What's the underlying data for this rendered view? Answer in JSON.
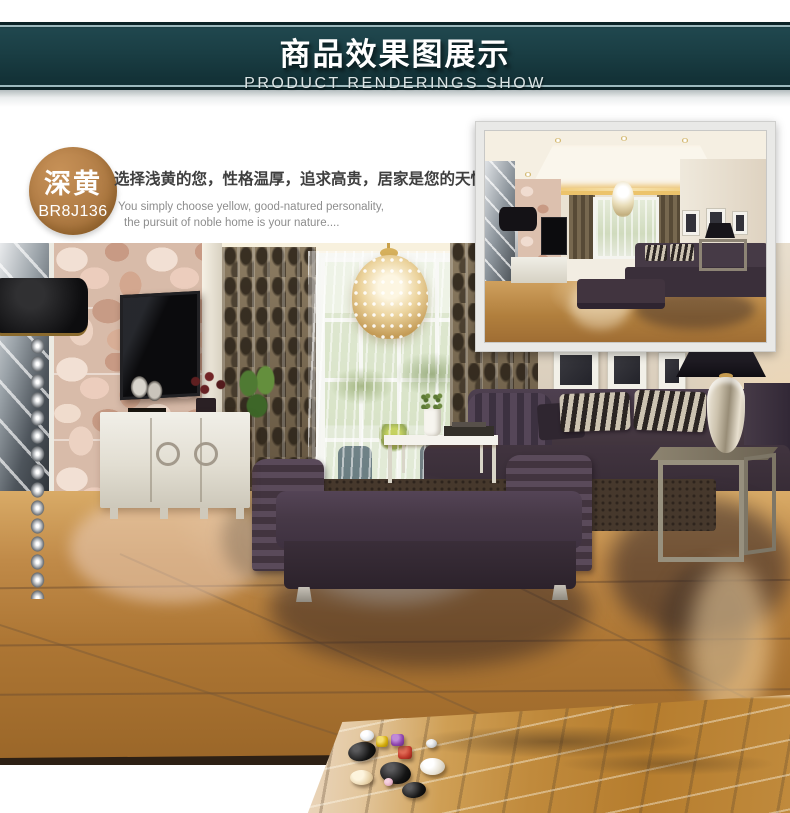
{
  "banner": {
    "title": "商品效果图展示",
    "subtitle": "PRODUCT RENDERINGS SHOW"
  },
  "product_badge": {
    "color_name": "深黄",
    "model_code": "BR8J136"
  },
  "intro": {
    "headline": "选择浅黄的您，性格温厚，追求高贵，居家是您的天性。",
    "caption_line1": "You simply choose yellow, good-natured personality,",
    "caption_line2": "the pursuit of noble home is your nature...."
  },
  "photos": {
    "main_label": "living-room-rendering",
    "inset_label": "living-room-rendering-second-view",
    "slab_label": "marble-tile-closeup-with-polished-stones"
  },
  "theme": {
    "banner_bg": "#1a3e44",
    "banner_bg_dark": "#102d32",
    "banner_line": "#9cb8bd",
    "badge_bg": "#b07c45",
    "headline_color": "#3f3f3f",
    "caption_color": "#8d8d8d",
    "floor_amber": "#c08a48",
    "sofa_plum": "#43363f",
    "slab_caramel": "#c08a3c",
    "curtain_brown": "#75654e",
    "stone_wall_pink": "#d8bba9",
    "inset_frame": "#e9e9e7"
  }
}
